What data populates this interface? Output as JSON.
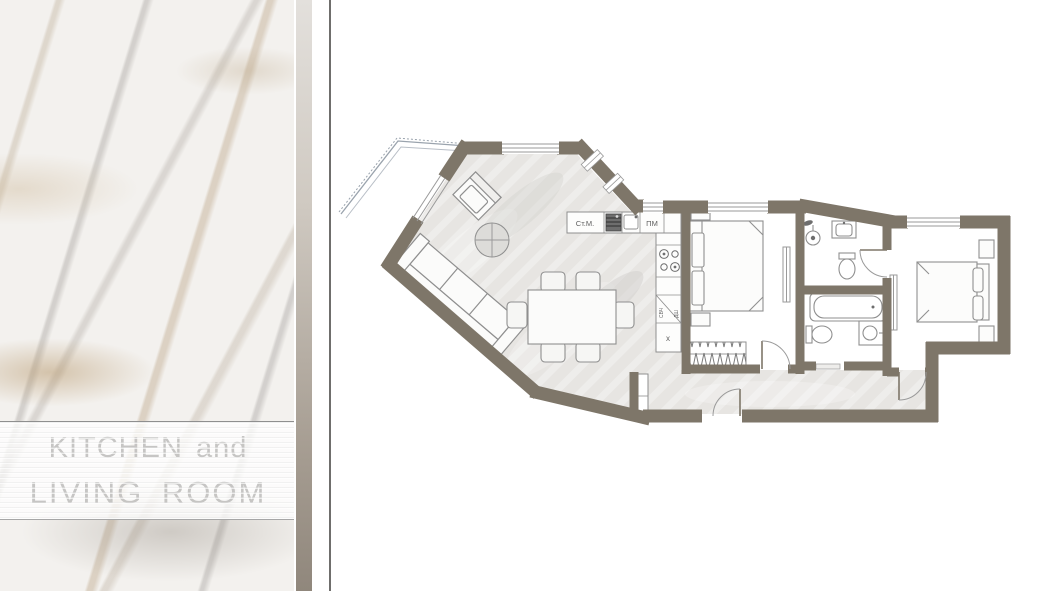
{
  "panel": {
    "title_line1": "KITCHEN and",
    "title_line2": "LIVING ROOM"
  },
  "floor_plan": {
    "labels": {
      "washing_machine": "Ст.М.",
      "dishwasher": "ПМ",
      "microwave": "СВЧ",
      "oven_cabinet": "ДШ",
      "fridge": "х"
    },
    "colors": {
      "wall": "#7e7669",
      "floor_wash": "#e7e5e2",
      "edge_bar_bottom": "#90877c",
      "thin_line": "#8f8f8f"
    }
  }
}
